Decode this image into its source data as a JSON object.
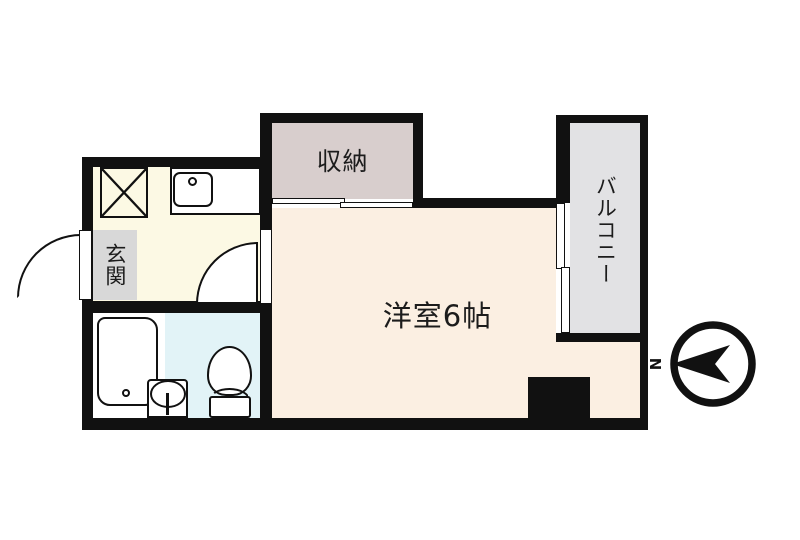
{
  "floorplan": {
    "rooms": {
      "closet_label": "収納",
      "balcony_label": "バルコニー",
      "entrance_label": "玄関",
      "main_room_label": "洋室6帖"
    },
    "compass": {
      "north_label": "N"
    },
    "colors": {
      "wall": "#111111",
      "kitchen_floor": "#FCF9E4",
      "main_room_floor": "#FBEFE2",
      "closet_floor": "#D8CECD",
      "balcony_floor": "#E2E2E4",
      "entrance_floor": "#D8D8D8",
      "washroom_floor": "#E2F3F7",
      "bath_floor": "#FFFFFF"
    }
  }
}
